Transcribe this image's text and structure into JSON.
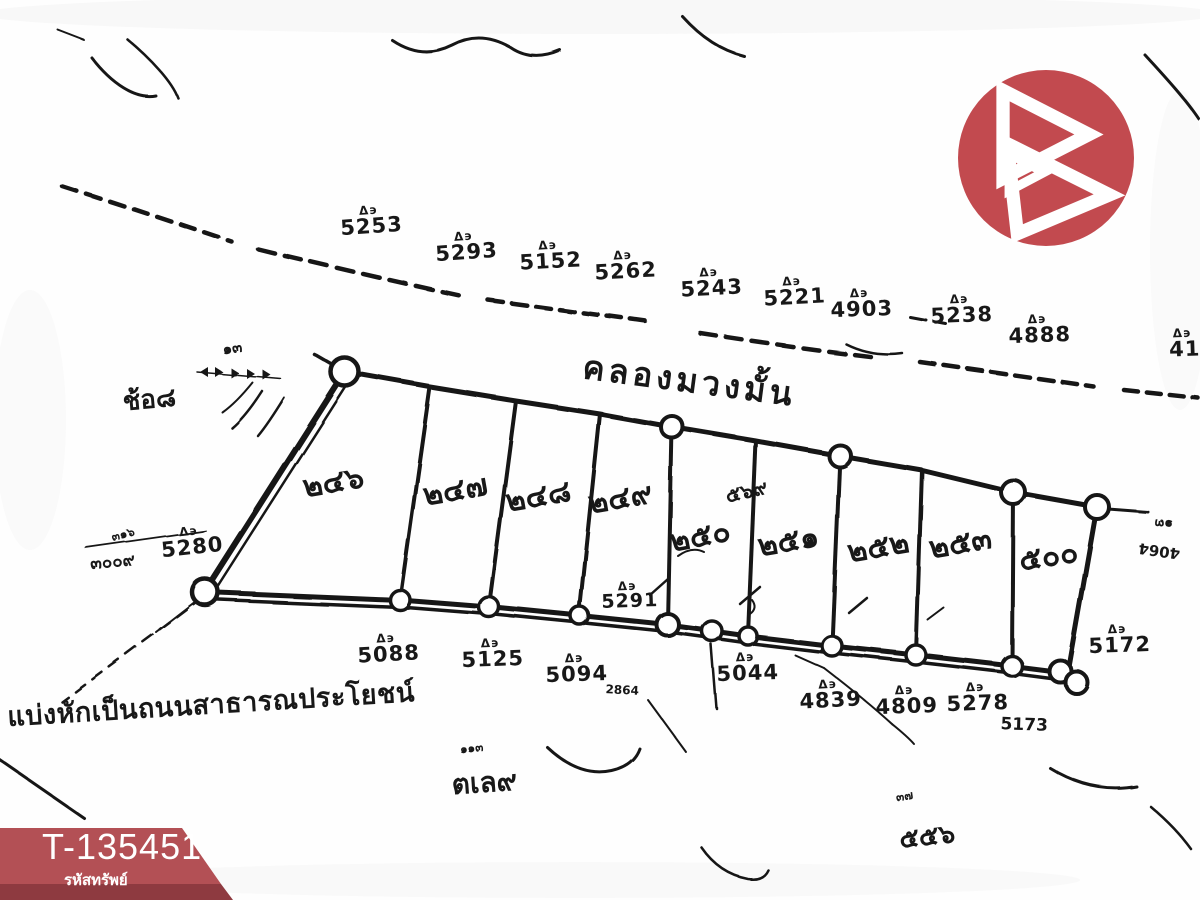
{
  "branding": {
    "logo": {
      "shape": "b-triangles-in-circle",
      "circle_color": "#c24a4f",
      "glyph_color": "#ffffff"
    },
    "ribbon": {
      "property_code": "T-135451",
      "caption": "รหัสทรัพย์",
      "band_color": "#b14a4f",
      "strip_color": "#8e3a40",
      "text_color": "#ffffff"
    }
  },
  "survey_map": {
    "ink_color": "#181818",
    "marker_glyph": "Δ϶",
    "canal_name": "คลองมวงมั้น",
    "road_note": "แบ่งหักเป็นถนนสาธารณประโยชน์",
    "upper_boundary_parcels": [
      "5253",
      "5293",
      "5152",
      "5262",
      "5243",
      "5221",
      "4903",
      "5238",
      "4888",
      "41"
    ],
    "plot_numbers_thai": [
      "๒๔๖",
      "๒๔๗",
      "๒๔๘",
      "๒๔๙",
      "๒๕๐",
      "๒๕๑",
      "๒๕๒",
      "๒๕๓",
      "๕๐๐"
    ],
    "lower_boundary_parcels": [
      "5088",
      "5125",
      "5094",
      "5044",
      "4839",
      "4809",
      "5278",
      "5173",
      "5172"
    ],
    "left_parcel": "5280",
    "mid_bottom_marker": "5291",
    "small_notes": {
      "under_5094": "2864",
      "left_tiny": "๓๑๖",
      "left_number": "๓๐๐๙",
      "north_tick": "๑๓",
      "right_rotated_a": "๑๓",
      "right_rotated_b": "4064",
      "overlay_strip5": "๕๖๙",
      "left_scribble": "ช้อ๘",
      "bottom_center_small": "๑๑๓",
      "bottom_center": "ตเล๙",
      "bottom_right_small": "๓๗",
      "bottom_right": "๕๕๖"
    }
  }
}
